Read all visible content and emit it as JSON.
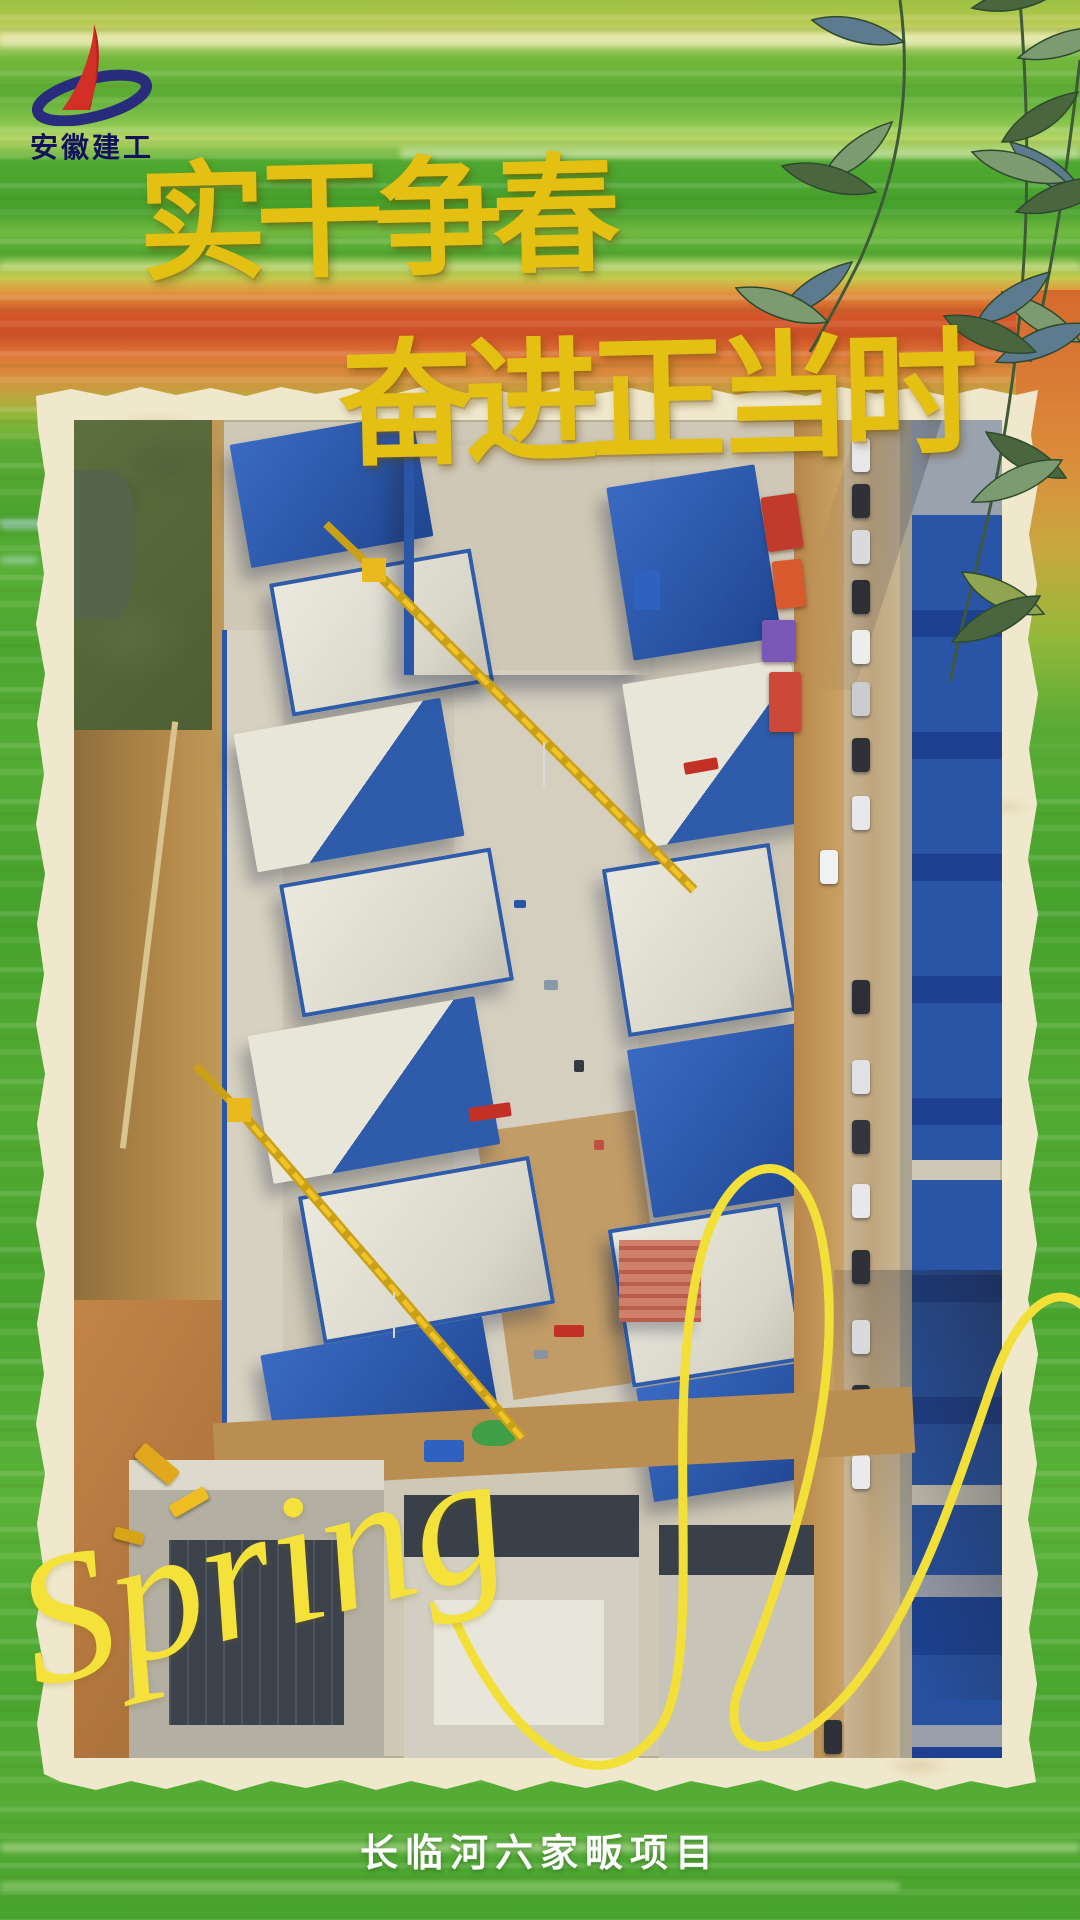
{
  "poster": {
    "logo": {
      "org_name": "安徽建工"
    },
    "title": {
      "line1": "实干争春",
      "line2": "奋进正当时"
    },
    "script_word": "Spring",
    "caption": "长临河六家畈项目",
    "colors": {
      "title_gold": "#e4c013",
      "script_yellow": "#f4e23a",
      "caption_white": "#ffffff",
      "logo_red": "#d22f26",
      "logo_navy": "#272c7d",
      "background_green": "#4ca630",
      "background_orange": "#d4582a",
      "paper_cream": "#f0e8cd",
      "safety_net_blue": "#2b58a8",
      "crane_yellow": "#e9b91e"
    }
  }
}
